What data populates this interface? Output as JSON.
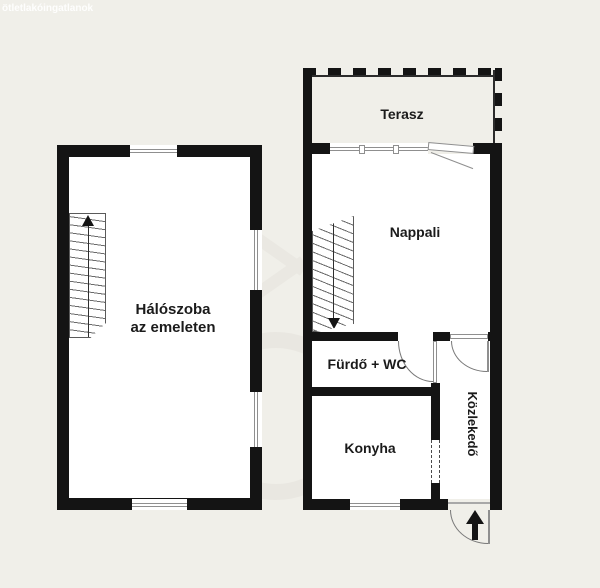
{
  "watermark": {
    "site_text": "ötletlakóingatlanok"
  },
  "colors": {
    "background": "#f0efe9",
    "wall": "#141414",
    "room_fill": "#ffffff",
    "window_frame": "#8f8f8f",
    "door_line": "#787878",
    "label_text": "#1b1b1b",
    "watermark_logo": "#e9e7e1"
  },
  "rooms": {
    "terasz": {
      "label": "Terasz"
    },
    "nappali": {
      "label": "Nappali"
    },
    "haloszoba": {
      "label_line1": "Hálószoba",
      "label_line2": "az emeleten"
    },
    "furdo": {
      "label": "Fürdő + WC"
    },
    "konyha": {
      "label": "Konyha"
    },
    "kozlekedo": {
      "label": "Közlekedő"
    }
  },
  "icons": {
    "stairs_up_arrow": "arrow-up",
    "stairs_down_arrow": "arrow-down",
    "entrance_arrow": "arrow-up"
  }
}
